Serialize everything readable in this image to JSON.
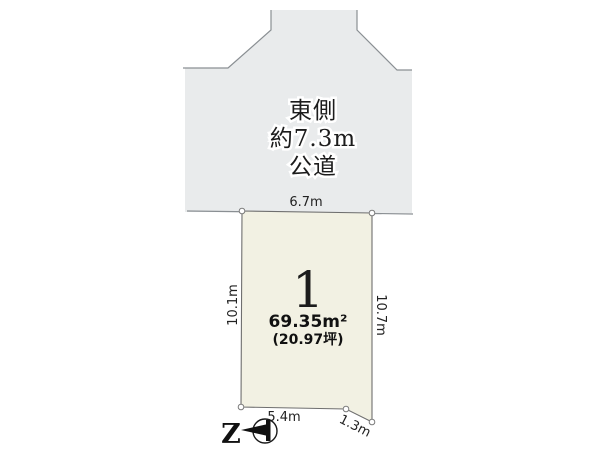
{
  "road": {
    "label_line1": "東側",
    "label_line2": "約7.3m",
    "label_line3": "公道",
    "fill": "#e9ebec"
  },
  "plot": {
    "number": "1",
    "area_sqm": "69.35m²",
    "area_tsubo": "(20.97坪)",
    "fill": "#f2f1e3"
  },
  "dimensions": {
    "top": "6.7m",
    "left": "10.1m",
    "right": "10.7m",
    "bottom": "5.4m",
    "bottom_right": "1.3m"
  },
  "compass": {
    "north_label": "Z"
  },
  "colors": {
    "road_fill": "#e9ebec",
    "plot_fill": "#f2f1e3",
    "outline": "#7d8083",
    "text": "#1c1c1c",
    "background": "#ffffff"
  }
}
